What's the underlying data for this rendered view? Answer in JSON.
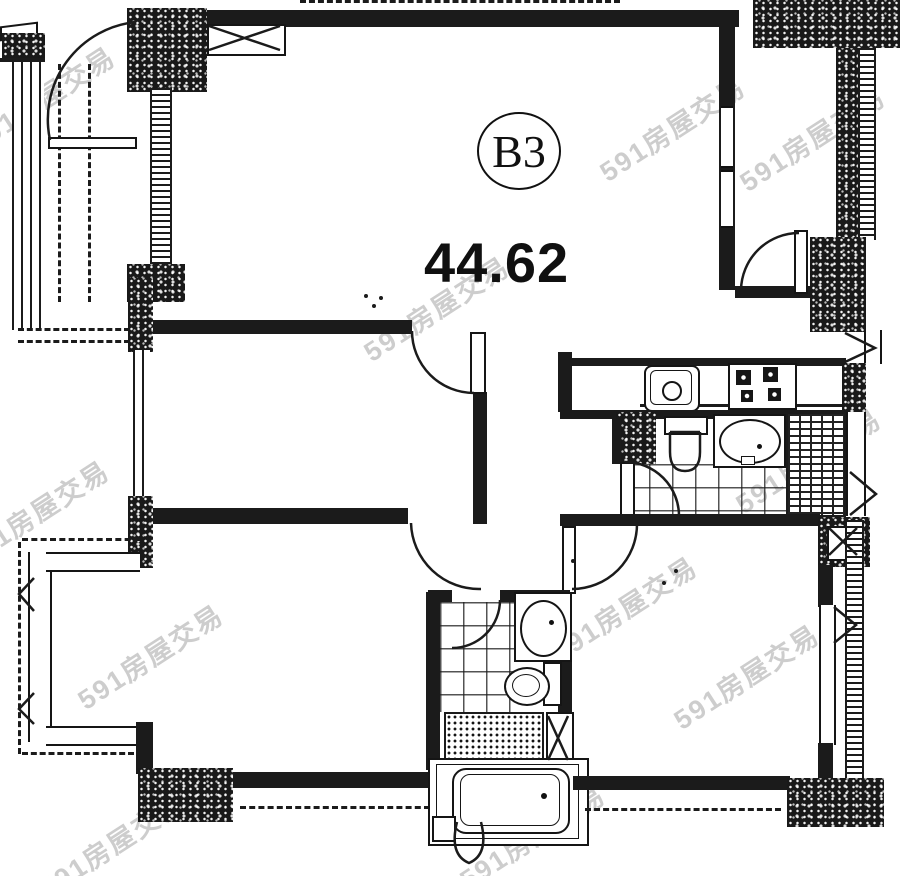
{
  "floorplan": {
    "unit_label": "B3",
    "area_value": "44.62",
    "watermark_text": "591房屋交易",
    "colors": {
      "ink": "#1b1b1b",
      "paper": "#ffffff",
      "watermark": "#969696"
    },
    "symbols": [
      "entry-door",
      "closet",
      "balcony-window",
      "bay-window",
      "kitchen-sink",
      "stove",
      "toilet",
      "wash-basin",
      "bathtub",
      "shower",
      "washer",
      "duct-shaft",
      "door-swing",
      "window-opening"
    ]
  }
}
